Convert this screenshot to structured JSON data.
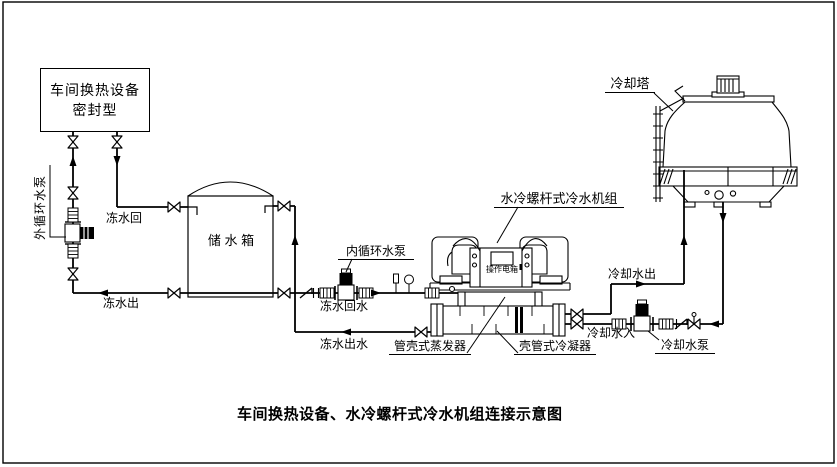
{
  "diagram": {
    "caption": "车间换热设备、水冷螺杆式冷水机组连接示意图",
    "workshop_box": {
      "line1": "车间换热设备",
      "line2": "密封型"
    },
    "labels": {
      "external_pump": "外循环水泵",
      "chilled_return": "冻水回",
      "chilled_out": "冻水出",
      "tank": "储 水 箱",
      "internal_pump": "内循环水泵",
      "chilled_return_water": "冻水回水",
      "chilled_out_water": "冻水出水",
      "evaporator": "管壳式蒸发器",
      "condenser": "壳管式冷凝器",
      "chiller_unit": "水冷螺杆式冷水机组",
      "control_box": "操作电箱",
      "cooling_tower": "冷却塔",
      "cooling_water_out": "冷却水出",
      "cooling_water_in": "冷却水入",
      "cooling_pump": "冷却水泵"
    },
    "colors": {
      "line": "#000000",
      "background": "#ffffff"
    }
  }
}
